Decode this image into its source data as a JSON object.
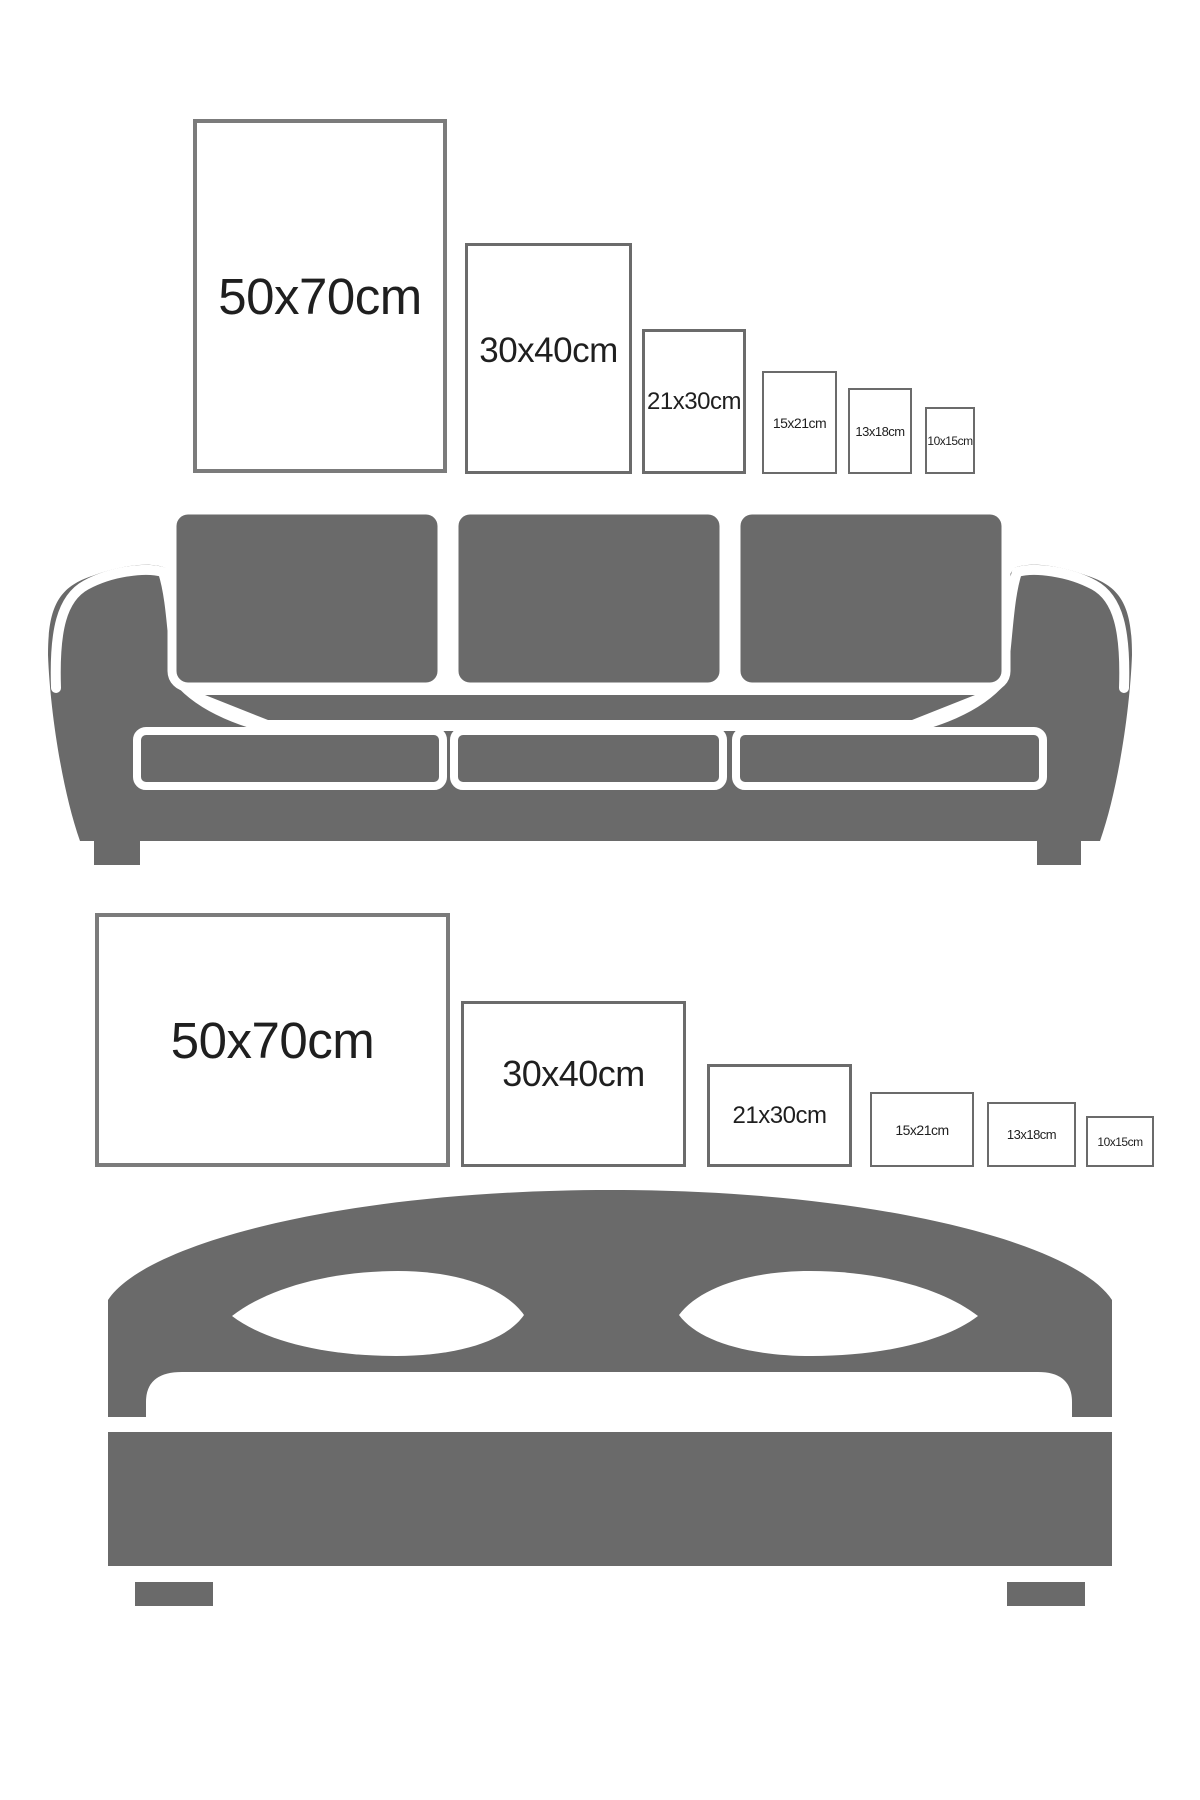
{
  "image_type": "poster-size-comparison-guide",
  "colors": {
    "background": "#ffffff",
    "furniture_gray": "#6a6a6a",
    "frame_border_large": "#7b7b7b",
    "frame_border_small": "#6b6b6b",
    "label_text": "#1f1f1f"
  },
  "sizes_cm": [
    "50x70",
    "30x40",
    "21x30",
    "15x21",
    "13x18",
    "10x15"
  ],
  "sofa_section": {
    "furniture": "sofa",
    "frames": [
      {
        "label": "50x70cm",
        "orientation": "portrait"
      },
      {
        "label": "30x40cm",
        "orientation": "portrait"
      },
      {
        "label": "21x30cm",
        "orientation": "portrait"
      },
      {
        "label": "15x21cm",
        "orientation": "portrait"
      },
      {
        "label": "13x18cm",
        "orientation": "portrait"
      },
      {
        "label": "10x15cm",
        "orientation": "portrait"
      }
    ]
  },
  "bed_section": {
    "furniture": "double-bed",
    "frames": [
      {
        "label": "50x70cm",
        "orientation": "landscape"
      },
      {
        "label": "30x40cm",
        "orientation": "landscape"
      },
      {
        "label": "21x30cm",
        "orientation": "landscape"
      },
      {
        "label": "15x21cm",
        "orientation": "landscape"
      },
      {
        "label": "13x18cm",
        "orientation": "landscape"
      },
      {
        "label": "10x15cm",
        "orientation": "landscape"
      }
    ]
  }
}
